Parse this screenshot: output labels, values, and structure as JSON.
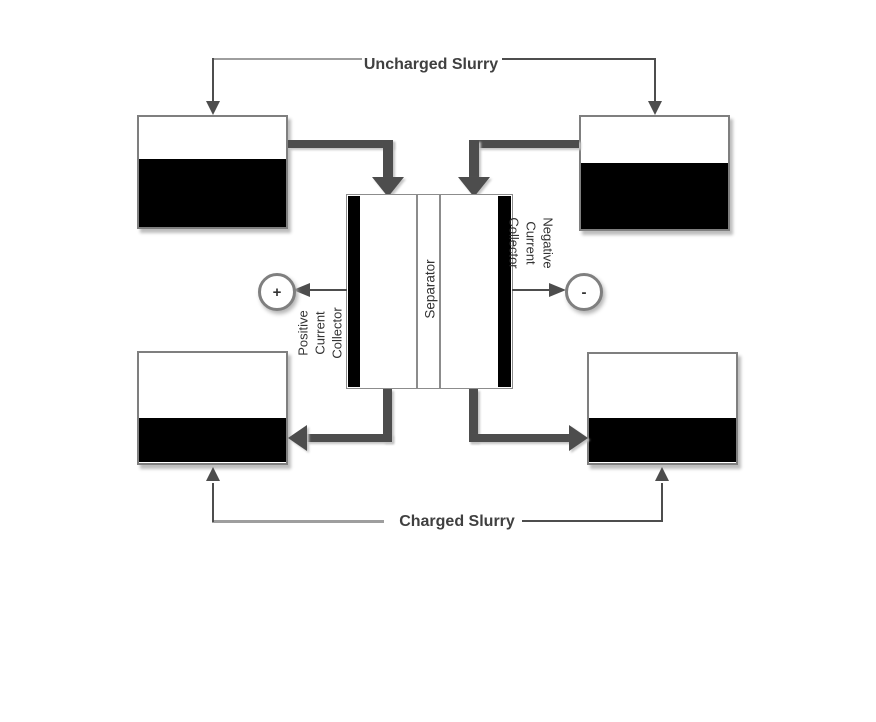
{
  "labels": {
    "uncharged_slurry": "Uncharged Slurry",
    "charged_slurry": "Charged Slurry",
    "separator": "Separator",
    "positive_collector": "Positive\nCurrent\nCollector",
    "negative_collector": "Negative\nCurrent\nCollector",
    "positive_terminal": "+",
    "negative_terminal": "-"
  },
  "tanks": [
    {
      "id": "uncharged-slurry-tank-left",
      "position": "top-left",
      "fill_percent": 60
    },
    {
      "id": "uncharged-slurry-tank-right",
      "position": "top-right",
      "fill_percent": 57
    },
    {
      "id": "charged-slurry-tank-left",
      "position": "bottom-left",
      "fill_percent": 42
    },
    {
      "id": "charged-slurry-tank-right",
      "position": "bottom-right",
      "fill_percent": 42
    }
  ],
  "colors": {
    "slurry": "#000000",
    "pipe": "#4d4d4d",
    "tank_border": "#7f7f7f",
    "cell_border": "#8c8c8c",
    "text": "#333333",
    "title_text": "#404040"
  }
}
